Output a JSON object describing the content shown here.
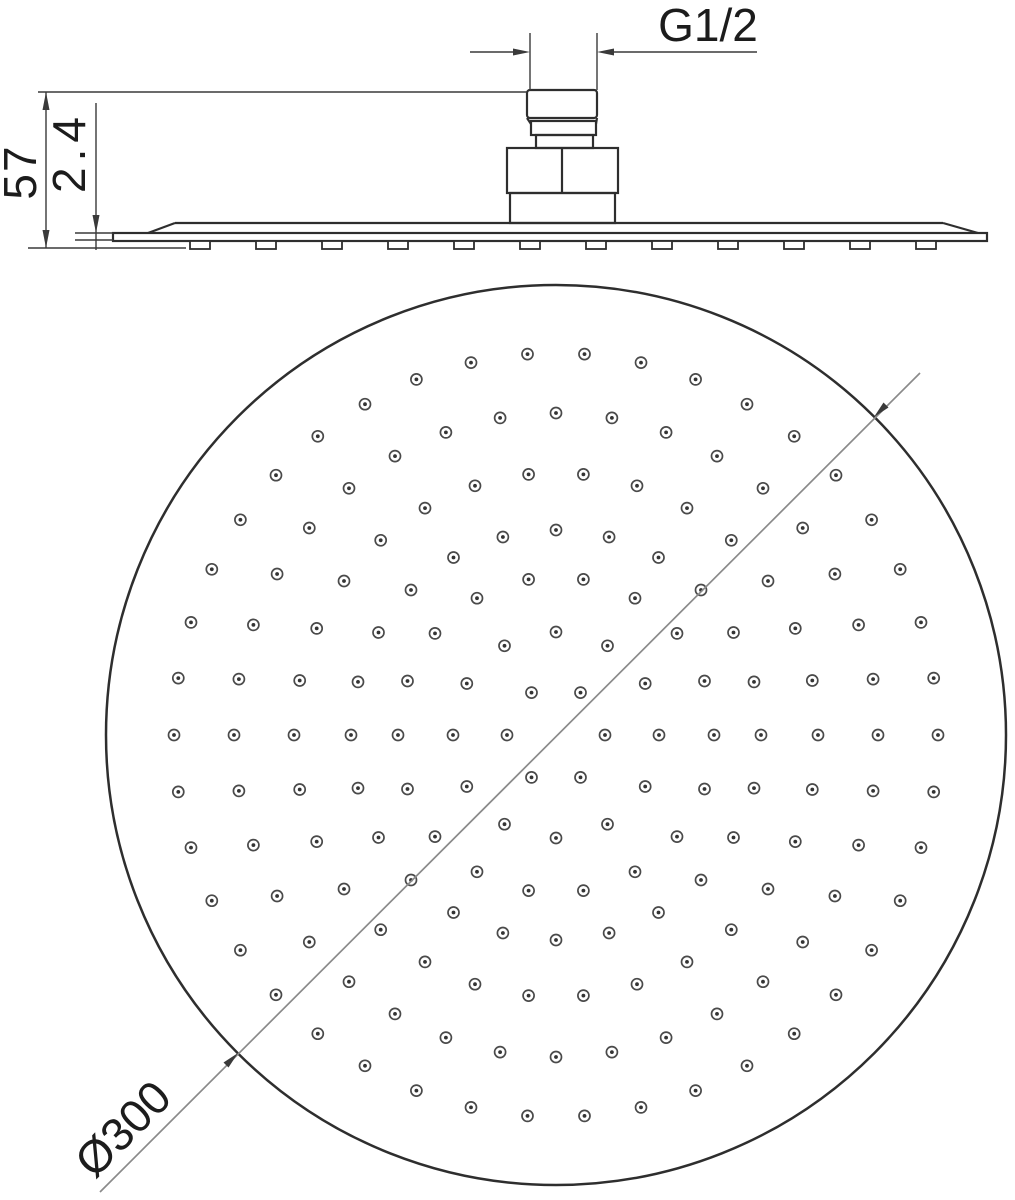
{
  "labels": {
    "thread_size": "G1/2",
    "overall_height": "57",
    "plate_thickness": "2.4",
    "face_diameter": "Ø300"
  },
  "colors": {
    "background": "#ffffff",
    "line": "#2e2e2e",
    "dimension": "#3a3a3a",
    "diagonal": "#8a8a8a",
    "nozzle_ring": "#4a4a4a",
    "nozzle_dot": "#333333"
  },
  "face_view": {
    "circle": {
      "cx": 556,
      "cy": 735,
      "r": 450
    },
    "nozzle": {
      "outer_r": 5.5,
      "dot_r": 1.9,
      "stroke_w": 1.7
    },
    "rings": [
      {
        "r": 49,
        "count": 6,
        "phase": 0
      },
      {
        "r": 103,
        "count": 12,
        "phase": 0
      },
      {
        "r": 158,
        "count": 18,
        "phase": 0
      },
      {
        "r": 205,
        "count": 24,
        "phase": 0
      },
      {
        "r": 262,
        "count": 30,
        "phase": 0
      },
      {
        "r": 322,
        "count": 36,
        "phase": 0
      },
      {
        "r": 382,
        "count": 42,
        "phase": 0
      }
    ],
    "nozzle_total": 168,
    "diameter_line": {
      "x1": 100,
      "y1": 1192,
      "x2": 920,
      "y2": 373
    }
  },
  "side_view": {
    "bumps": {
      "count": 12,
      "first_center_x": 200,
      "spacing": 66,
      "width": 20,
      "top_y": 241,
      "height": 8
    }
  }
}
